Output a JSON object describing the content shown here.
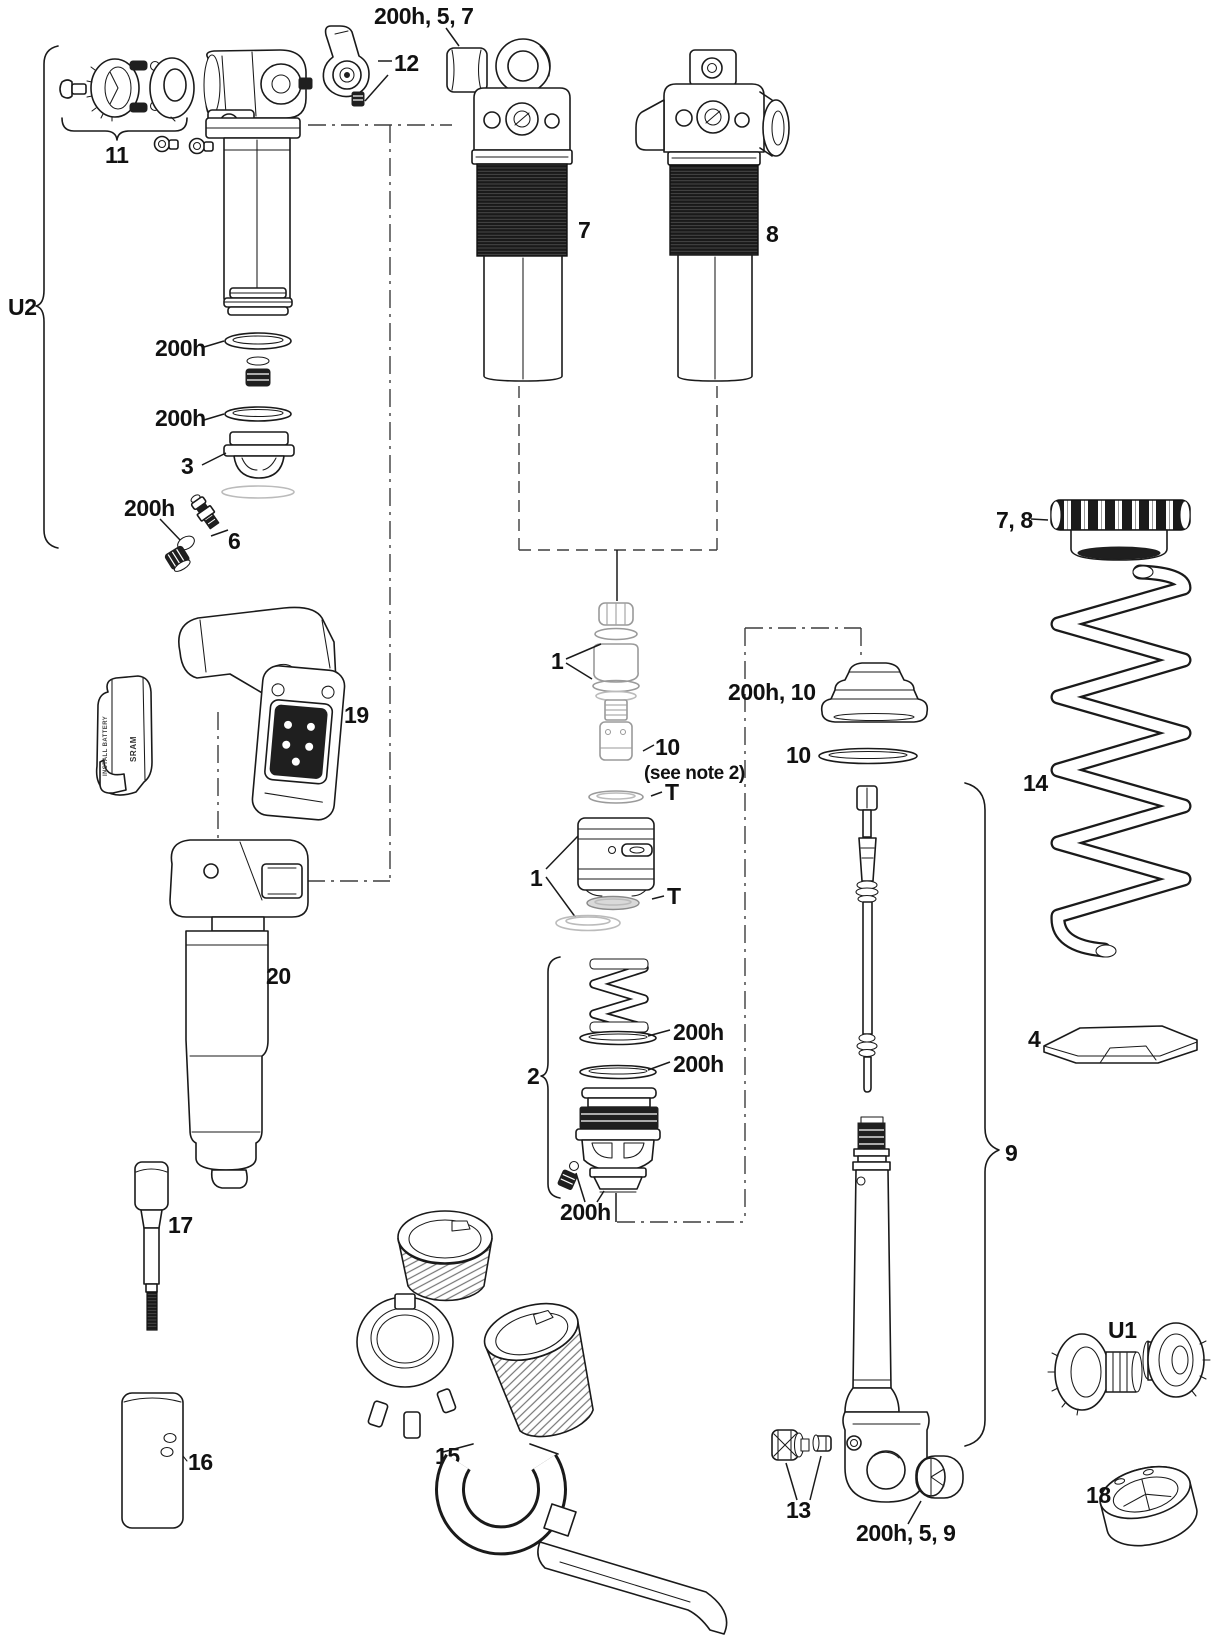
{
  "labels": {
    "u2": "U2",
    "group11": "11",
    "item12": "12",
    "bumper_top": "200h, 5, 7",
    "body7": "7",
    "body8": "8",
    "aircan_200h_a": "200h",
    "aircan_200h_b": "200h",
    "item3": "3",
    "aircan_200h_c": "200h",
    "item6": "6",
    "item19": "19",
    "item20": "20",
    "item1_caps": "1",
    "item10_fitting": "10",
    "note10": "(see note 2)",
    "t_upper": "T",
    "item1_piston": "1",
    "t_lower": "T",
    "bumper_mid": "200h, 10",
    "washer10": "10",
    "group2": "2",
    "grp2_200h_a": "200h",
    "grp2_200h_b": "200h",
    "grp2_200h_c": "200h",
    "item17": "17",
    "item16": "16",
    "item15": "15",
    "item13": "13",
    "bumper_bottom": "200h, 5, 9",
    "collar78": "7, 8",
    "spring14": "14",
    "seat4": "4",
    "group9": "9",
    "u1": "U1",
    "item18": "18"
  },
  "battery": {
    "install": "INSTALL BATTERY",
    "brand": "SRAM"
  },
  "colors": {
    "line": "#1a1a1a",
    "dark": "#1f1f1f",
    "ghost": "#9a9a9a"
  }
}
